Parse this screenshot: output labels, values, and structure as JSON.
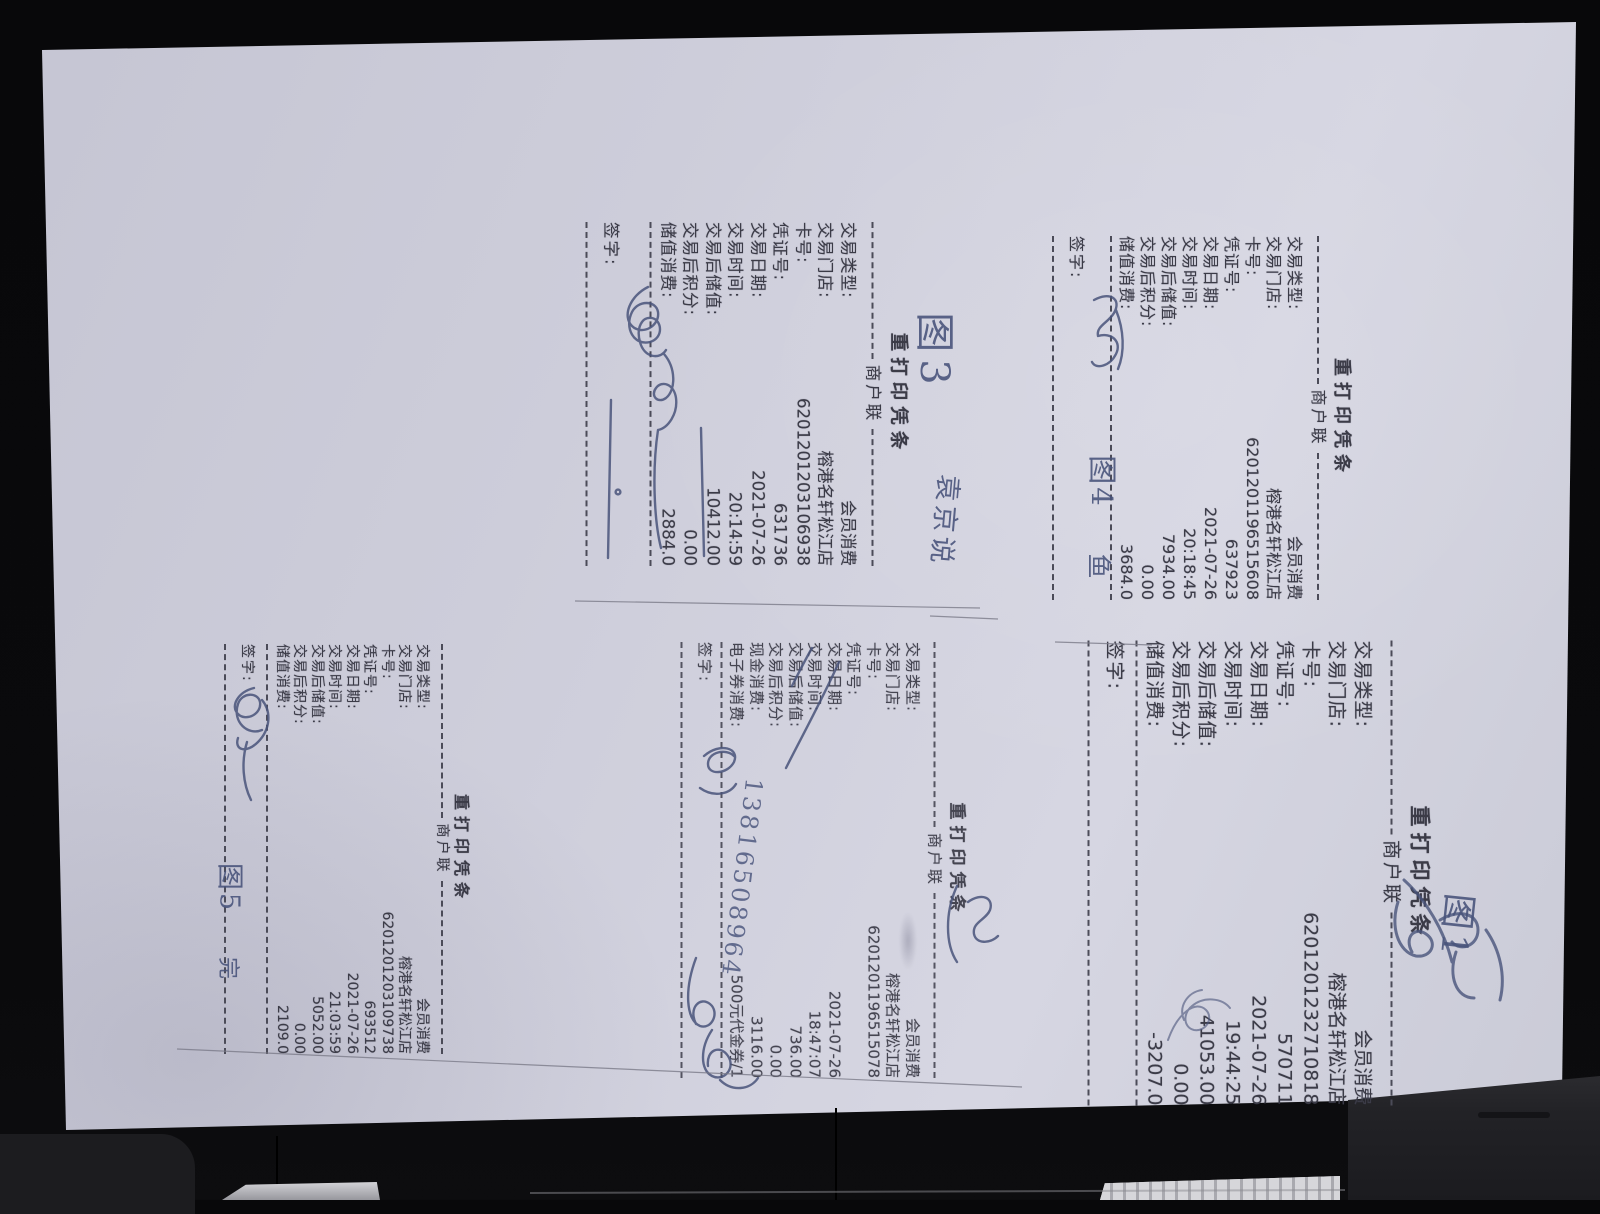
{
  "labels": {
    "title": "重打印凭条",
    "copy": "商户联",
    "sign": "签字:"
  },
  "receipts": [
    {
      "rows": [
        [
          "交易类型:",
          "会员消费"
        ],
        [
          "交易门店:",
          "榕港名轩松江店"
        ],
        [
          "卡号:",
          "6201201196515608"
        ],
        [
          "凭证号:",
          "637923"
        ],
        [
          "交易日期:",
          "2021-07-26"
        ],
        [
          "交易时间:",
          "20:18:45"
        ],
        [
          "交易后储值:",
          "7934.00"
        ],
        [
          "交易后积分:",
          "0.00"
        ],
        [
          "储值消费:",
          "3684.0"
        ]
      ]
    },
    {
      "rows": [
        [
          "交易类型:",
          "会员消费"
        ],
        [
          "交易门店:",
          "榕港名轩松江店"
        ],
        [
          "卡号:",
          "6201201203106938"
        ],
        [
          "凭证号:",
          "631736"
        ],
        [
          "交易日期:",
          "2021-07-26"
        ],
        [
          "交易时间:",
          "20:14:59"
        ],
        [
          "交易后储值:",
          "10412.00"
        ],
        [
          "交易后积分:",
          "0.00"
        ],
        [
          "储值消费:",
          "2884.0"
        ]
      ]
    },
    {
      "rows": [
        [
          "交易类型:",
          "会员消费"
        ],
        [
          "交易门店:",
          "榕港名轩松江店"
        ],
        [
          "卡号:",
          "6201201203109738"
        ],
        [
          "凭证号:",
          "693512"
        ],
        [
          "交易日期:",
          "2021-07-26"
        ],
        [
          "交易时间:",
          "21:03:59"
        ],
        [
          "交易后储值:",
          "5052.00"
        ],
        [
          "交易后积分:",
          "0.00"
        ],
        [
          "储值消费:",
          "2109.0"
        ]
      ]
    },
    {
      "rows": [
        [
          "交易类型:",
          "会员消费"
        ],
        [
          "交易门店:",
          "榕港名轩松江店"
        ],
        [
          "卡号:",
          "6201201196515078"
        ],
        [
          "凭证号:",
          ""
        ],
        [
          "交易日期:",
          "2021-07-26"
        ],
        [
          "交易时间:",
          "18:47:07"
        ],
        [
          "交易后储值:",
          "736.00"
        ],
        [
          "交易后积分:",
          "0.00"
        ],
        [
          "现金消费:",
          "3116.00"
        ],
        [
          "电子券消费:",
          "500元代金券/1"
        ]
      ]
    },
    {
      "rows": [
        [
          "交易类型:",
          "会员消费"
        ],
        [
          "交易门店:",
          "榕港名轩松江店"
        ],
        [
          "卡号:",
          "6201201232710818"
        ],
        [
          "凭证号:",
          "570711"
        ],
        [
          "交易日期:",
          "2021-07-26"
        ],
        [
          "交易时间:",
          "19:44:25"
        ],
        [
          "交易后储值:",
          "41053.00"
        ],
        [
          "交易后积分:",
          "0.00"
        ],
        [
          "储值消费:",
          "-3207.0"
        ]
      ]
    }
  ],
  "annotations": {
    "fig3": "图3",
    "name3": "袁京说",
    "fig4": "图4",
    "fish4": "鱼",
    "fig5": "图5",
    "done5": "完",
    "fig1": "图1",
    "phone": "13816508964"
  }
}
